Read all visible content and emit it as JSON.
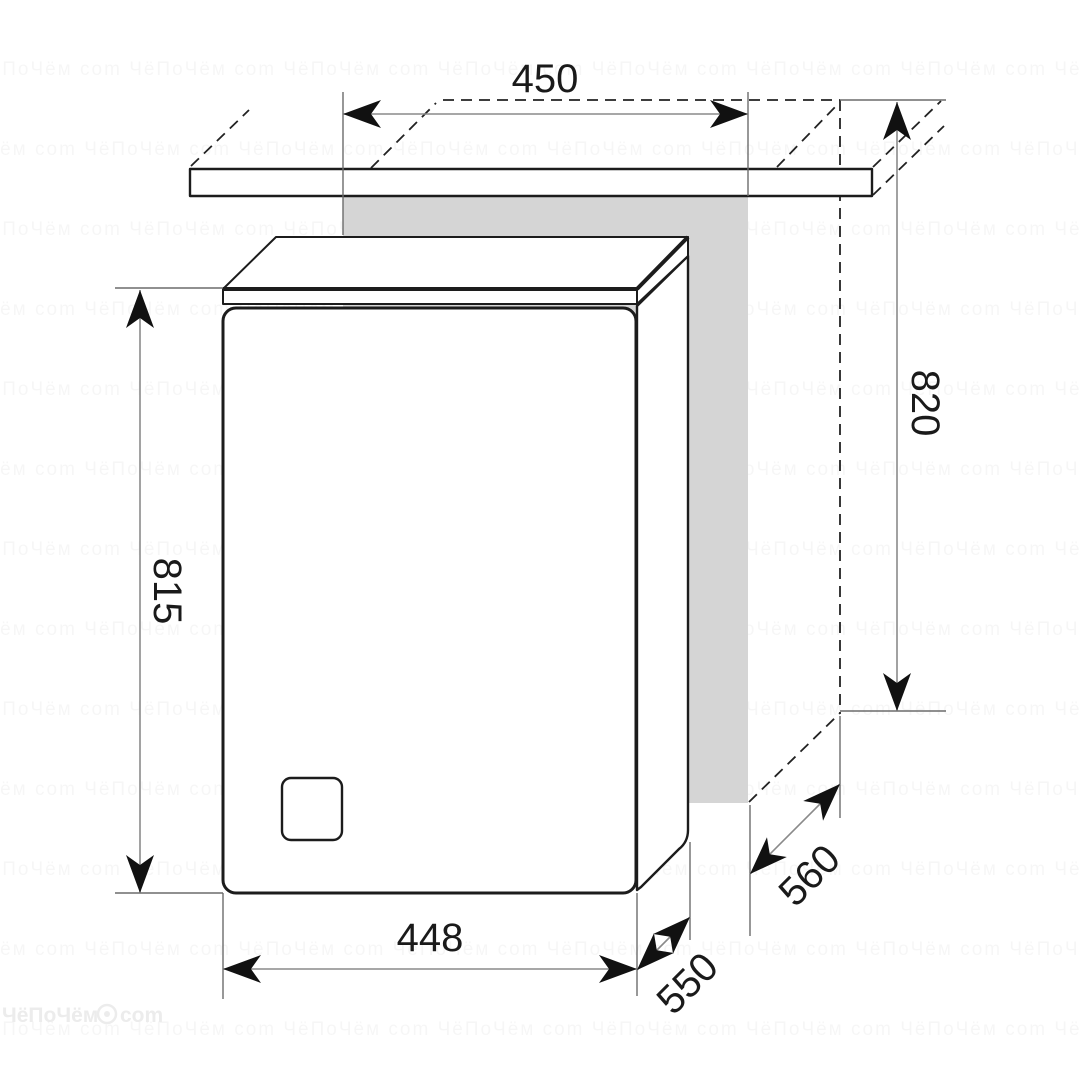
{
  "diagram": {
    "type": "appliance-installation-dimension-drawing",
    "dimensions": {
      "niche_width": "450",
      "niche_height": "820",
      "appliance_height": "815",
      "appliance_width": "448",
      "appliance_depth": "550",
      "niche_depth": "560"
    },
    "colors": {
      "outline": "#1c1c1c",
      "dimension_line": "#8a8a8a",
      "extension_line": "#6b6b6b",
      "arrow": "#111111",
      "niche_panel": "#d5d5d5",
      "background": "#ffffff",
      "watermark": "#ececec"
    }
  },
  "watermark": {
    "brand_left": "ЧёПоЧём",
    "brand_right": "com",
    "tile_text": "ЧёПоЧём com      "
  }
}
